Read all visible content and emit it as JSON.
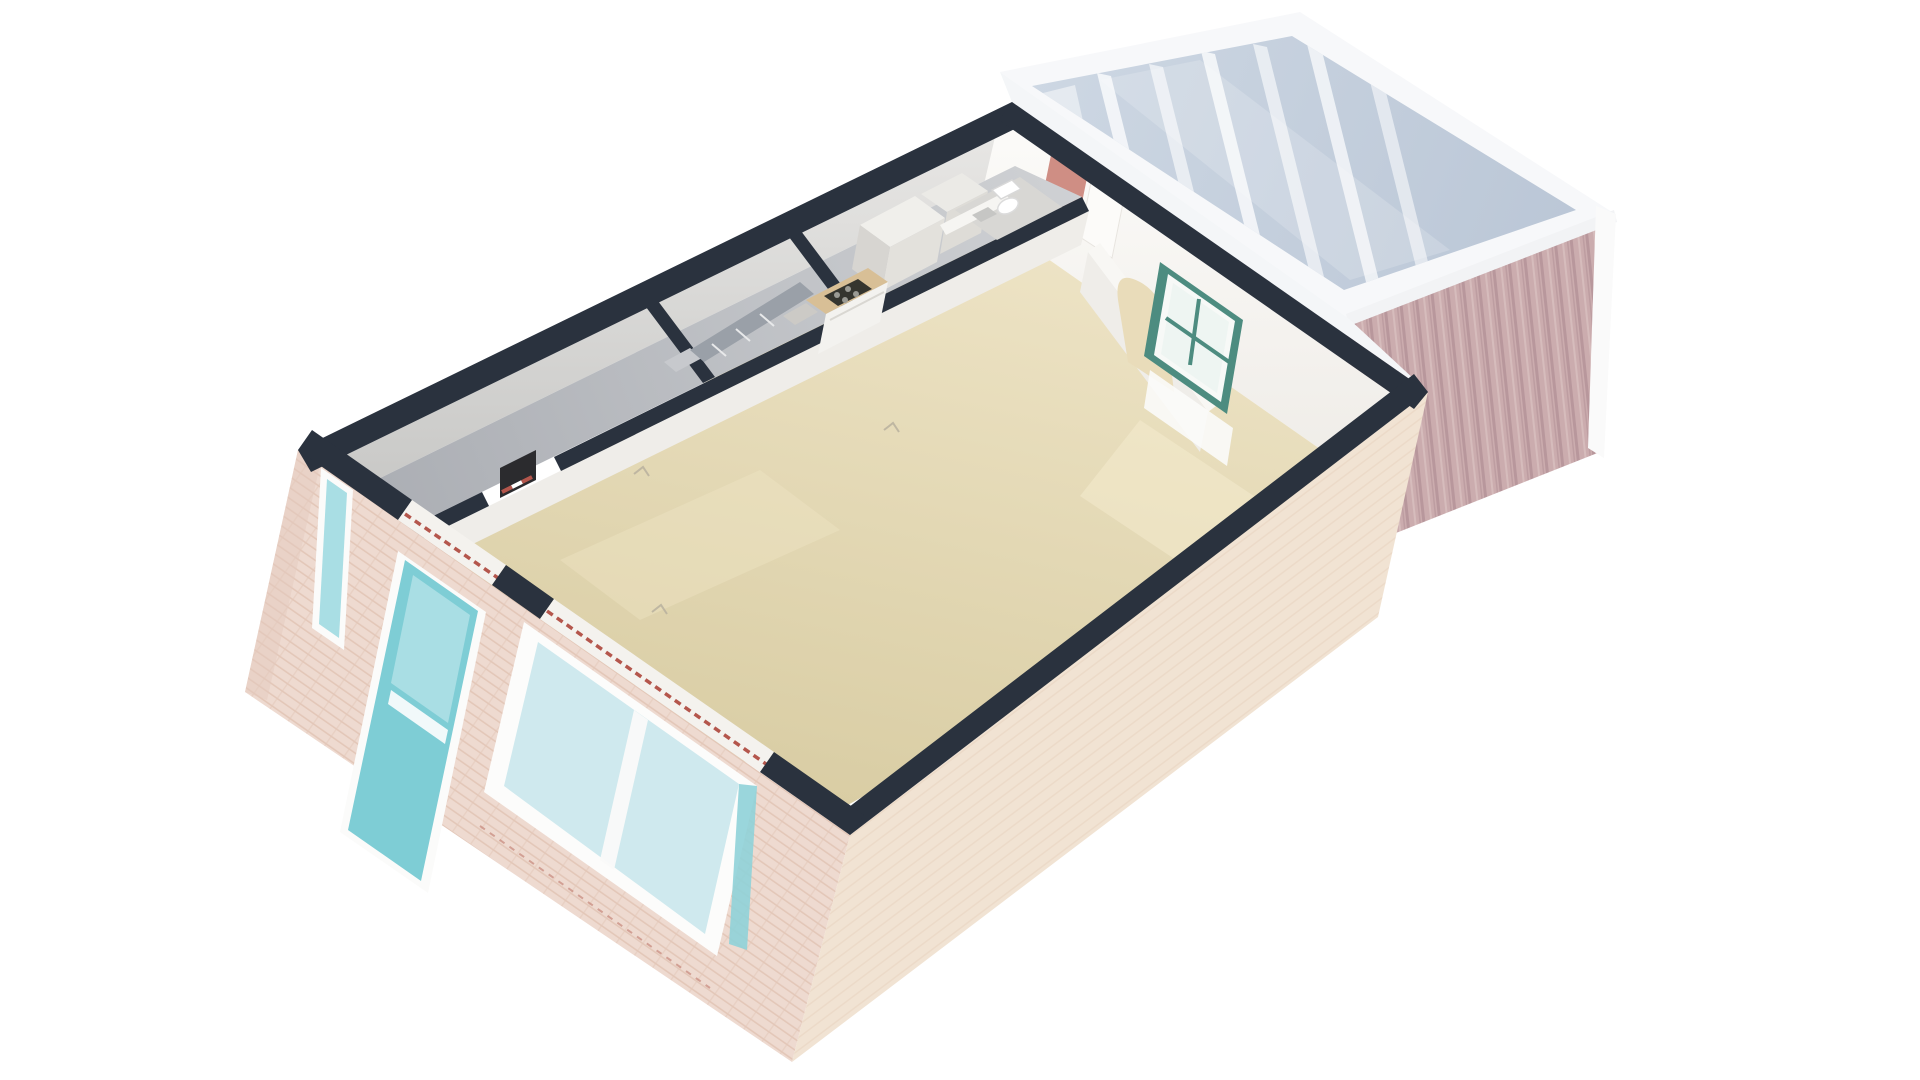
{
  "meta": {
    "title": "3D floor plan — ground floor cutaway render",
    "view": "isometric perspective from above (south-west)",
    "background": "#ffffff"
  },
  "colors": {
    "background": "#ffffff",
    "wall_cut_navy": "#2a323e",
    "interior_wall_white": "#f2f0ec",
    "hall_floor_gray": "#b9bcc2",
    "living_floor_beige": "#e4d9b6",
    "front_brick": "#eedacf",
    "brick_course": "#e0c2b2",
    "side_brick": "#f0e1d0",
    "front_door_turquoise": "#7ecdd5",
    "door_glass": "#a9dee4",
    "window_glass": "#cfe9ee",
    "window_teal_frame": "#4d8c80",
    "conservatory_glass": "#c6d0de",
    "conservatory_frame_white": "#f7f8fa",
    "conservatory_wood": "#c9a9ac",
    "counter_wood": "#d8bf96",
    "stove_dark": "#35352f",
    "stair_gray": "#9aa0a8",
    "accent_salmon": "#cf8e84",
    "accent_red": "#b4564c",
    "meter_dark": "#2b2b2e",
    "toilet_white": "#ffffff"
  },
  "building": {
    "rooms": [
      {
        "name": "entrance-hall",
        "floor": "gray"
      },
      {
        "name": "staircase",
        "floor": "gray"
      },
      {
        "name": "storage-closet",
        "floor": "gray"
      },
      {
        "name": "kitchen",
        "floor": "gray"
      },
      {
        "name": "bathroom-wc",
        "floor": "gray"
      },
      {
        "name": "living-room",
        "floor": "beige"
      },
      {
        "name": "dining-area",
        "floor": "beige"
      },
      {
        "name": "conservatory",
        "floor": "under glass roof"
      }
    ],
    "features": [
      "dark cut-away wall tops",
      "turquoise front door with glazed panel",
      "glazed sidelight beside front door",
      "large white-framed front window",
      "teal-framed window between dining area and conservatory",
      "arched interior doorway",
      "kitchen units with gas stove and timber counter",
      "toilet with cistern",
      "staircase flight",
      "conservatory glass roof with white rafters",
      "mauve timber-clad conservatory wall",
      "pale pink brick facades",
      "meter cabinet with red-white stripes at hall doorway"
    ]
  }
}
